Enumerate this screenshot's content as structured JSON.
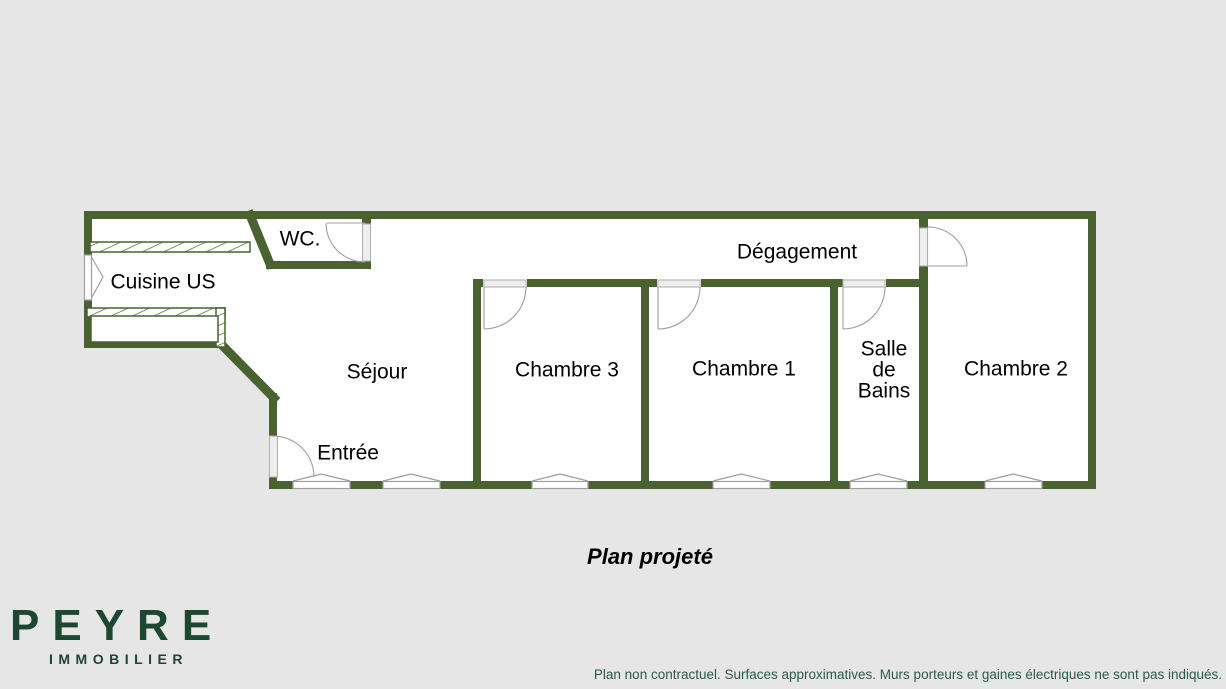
{
  "plan": {
    "title": "Plan projeté",
    "rooms": {
      "cuisine_us": {
        "label": "Cuisine US"
      },
      "wc": {
        "label": "WC."
      },
      "degagement": {
        "label": "Dégagement"
      },
      "sejour": {
        "label": "Séjour"
      },
      "entree": {
        "label": "Entrée"
      },
      "chambre_3": {
        "label": "Chambre 3"
      },
      "chambre_1": {
        "label": "Chambre 1"
      },
      "salle_de_bains": {
        "line1": "Salle",
        "line2": "de",
        "line3": "Bains"
      },
      "chambre_2": {
        "label": "Chambre 2"
      }
    }
  },
  "branding": {
    "logo_name": "PEYRE",
    "logo_subtitle": "IMMOBILIER"
  },
  "footer": {
    "disclaimer": "Plan non contractuel. Surfaces approximatives. Murs porteurs et gaines électriques ne sont pas indiqués."
  },
  "colors": {
    "wall_green": "#4a6130",
    "logo_green": "#1b4733",
    "disclaimer_green": "#2b5a48",
    "bg": "#e6e6e6",
    "interior_white": "#ffffff"
  }
}
